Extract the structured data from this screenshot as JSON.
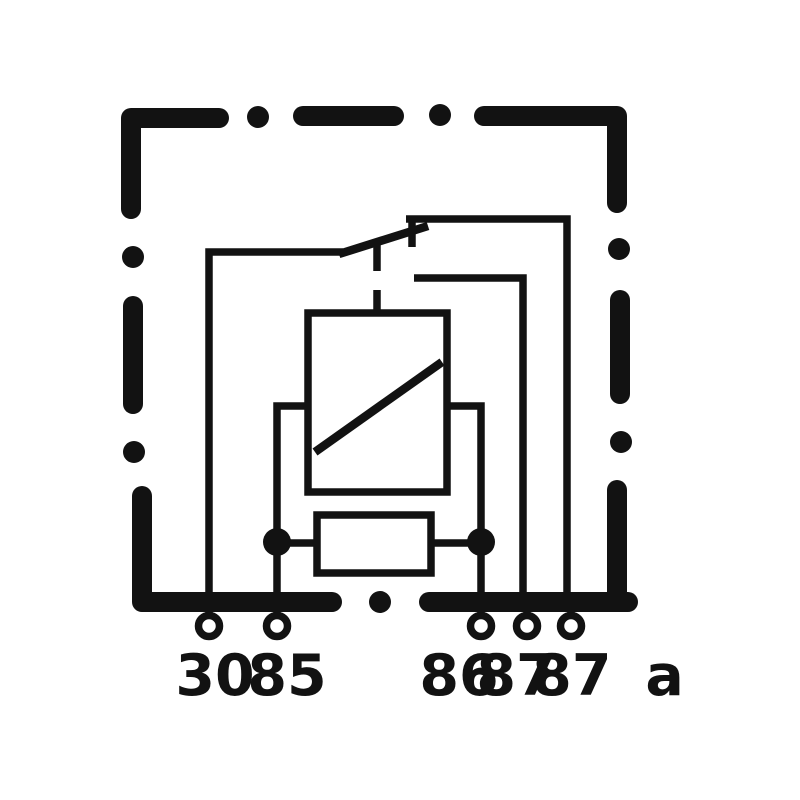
{
  "diagram": {
    "kind": "relay wiring schematic",
    "background_color": "#ffffff",
    "ink_color": "#121212",
    "housing": {
      "name": "relay-housing",
      "border_style": "dash-dot"
    },
    "components": [
      {
        "name": "changeover-switch",
        "state": "resting on 87a contact"
      },
      {
        "name": "relay-coil",
        "symbol": "rectangle-with-diagonal"
      },
      {
        "name": "parallel-resistor",
        "symbol": "rectangle"
      }
    ],
    "terminals": [
      {
        "id": "30",
        "label": "30"
      },
      {
        "id": "85",
        "label": "85"
      },
      {
        "id": "86",
        "label": "86"
      },
      {
        "id": "87",
        "label": "87"
      },
      {
        "id": "87a",
        "label": "87 a"
      }
    ]
  }
}
